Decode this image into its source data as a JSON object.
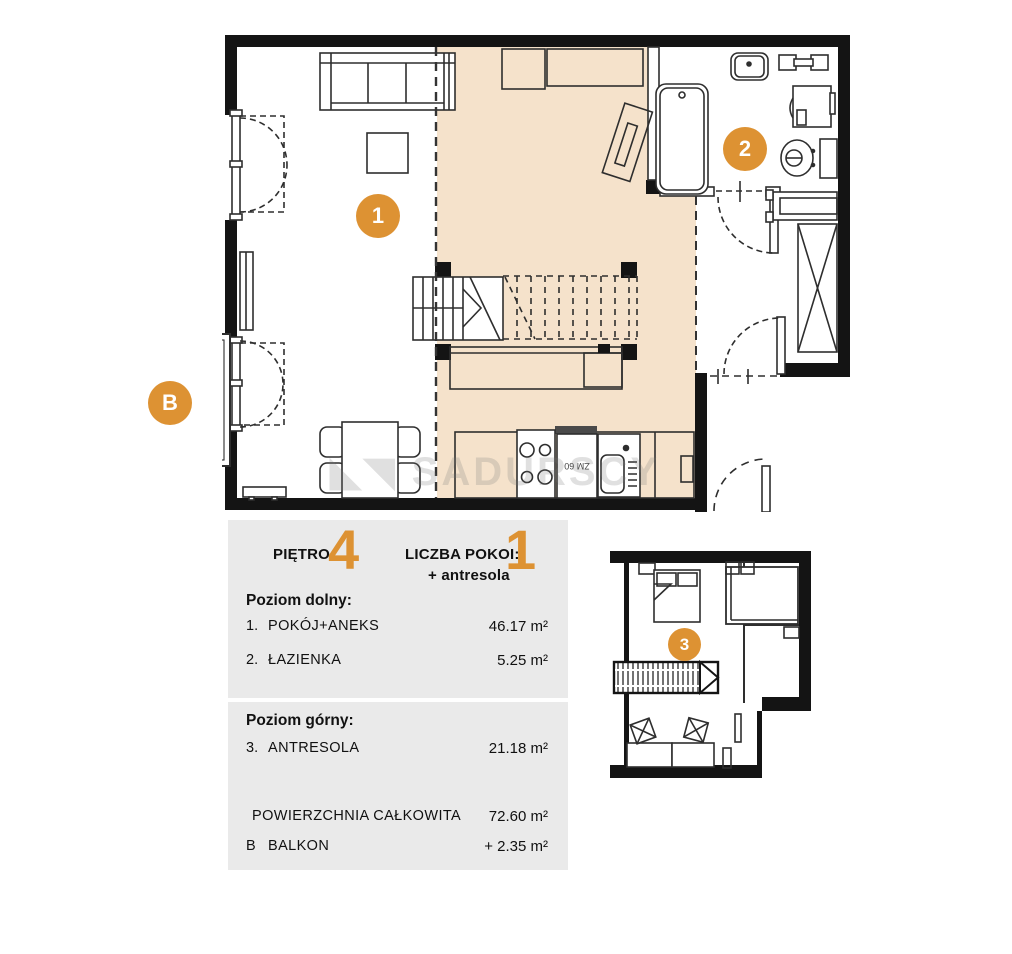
{
  "colors": {
    "accent": "#DD9233",
    "floor_shade": "#F5E2CB",
    "panel_bg": "#EAEAEA",
    "wall": "#141414"
  },
  "plan": {
    "markers": {
      "room1": "1",
      "room2": "2",
      "balcony": "B",
      "mezzanine": "3"
    },
    "labels": {
      "dishwasher": "ZM 60"
    },
    "watermark": "SADURSCY"
  },
  "panel": {
    "floor_label": "PIĘTRO:",
    "floor_value": "4",
    "rooms_label": "LICZBA POKOI:",
    "rooms_value": "1",
    "rooms_extra": "+ antresola",
    "lower_title": "Poziom dolny:",
    "lower_rows": [
      {
        "no": "1.",
        "name": "POKÓJ+ANEKS",
        "area": "46.17 m²"
      },
      {
        "no": "2.",
        "name": "ŁAZIENKA",
        "area": "5.25 m²"
      }
    ],
    "upper_title": "Poziom górny:",
    "upper_rows": [
      {
        "no": "3.",
        "name": "ANTRESOLA",
        "area": "21.18 m²"
      }
    ],
    "total_row": {
      "name": "POWIERZCHNIA CAŁKOWITA",
      "area": "72.60 m²"
    },
    "balcony_row": {
      "no": "B",
      "name": "BALKON",
      "area": "+  2.35 m²"
    }
  }
}
